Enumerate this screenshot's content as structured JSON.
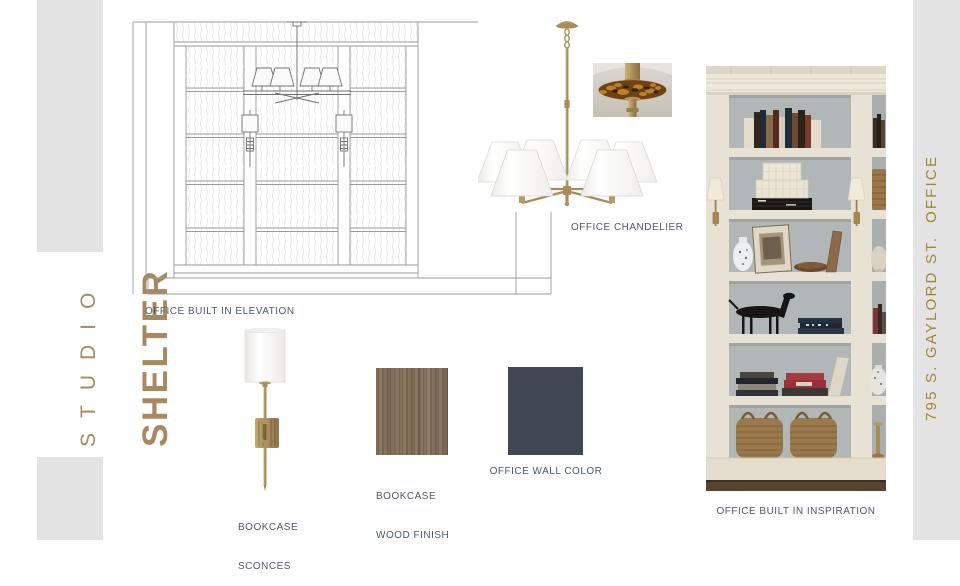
{
  "brand": {
    "line1": "STUDIO",
    "line2": "SHELTER"
  },
  "address": "795 S. GAYLORD ST.  OFFICE",
  "labels": {
    "elevation": "OFFICE BUILT IN ELEVATION",
    "chandelier": "OFFICE CHANDELIER",
    "sconces": [
      "BOOKCASE",
      "SCONCES"
    ],
    "wood": [
      "BOOKCASE",
      "WOOD FINISH"
    ],
    "wall": "OFFICE WALL COLOR",
    "inspiration": "OFFICE BUILT IN INSPIRATION"
  },
  "colors": {
    "brand_brown": "#a8885e",
    "address_gold": "#a3862f",
    "label_slate": "#4b5968",
    "sidebar_gray": "#e3e3e4",
    "office_wall_swatch": "#3f4754",
    "wood_finish_base": "#7b6950",
    "brass": "#b39a66",
    "drawing_line": "#9a9a9a"
  }
}
